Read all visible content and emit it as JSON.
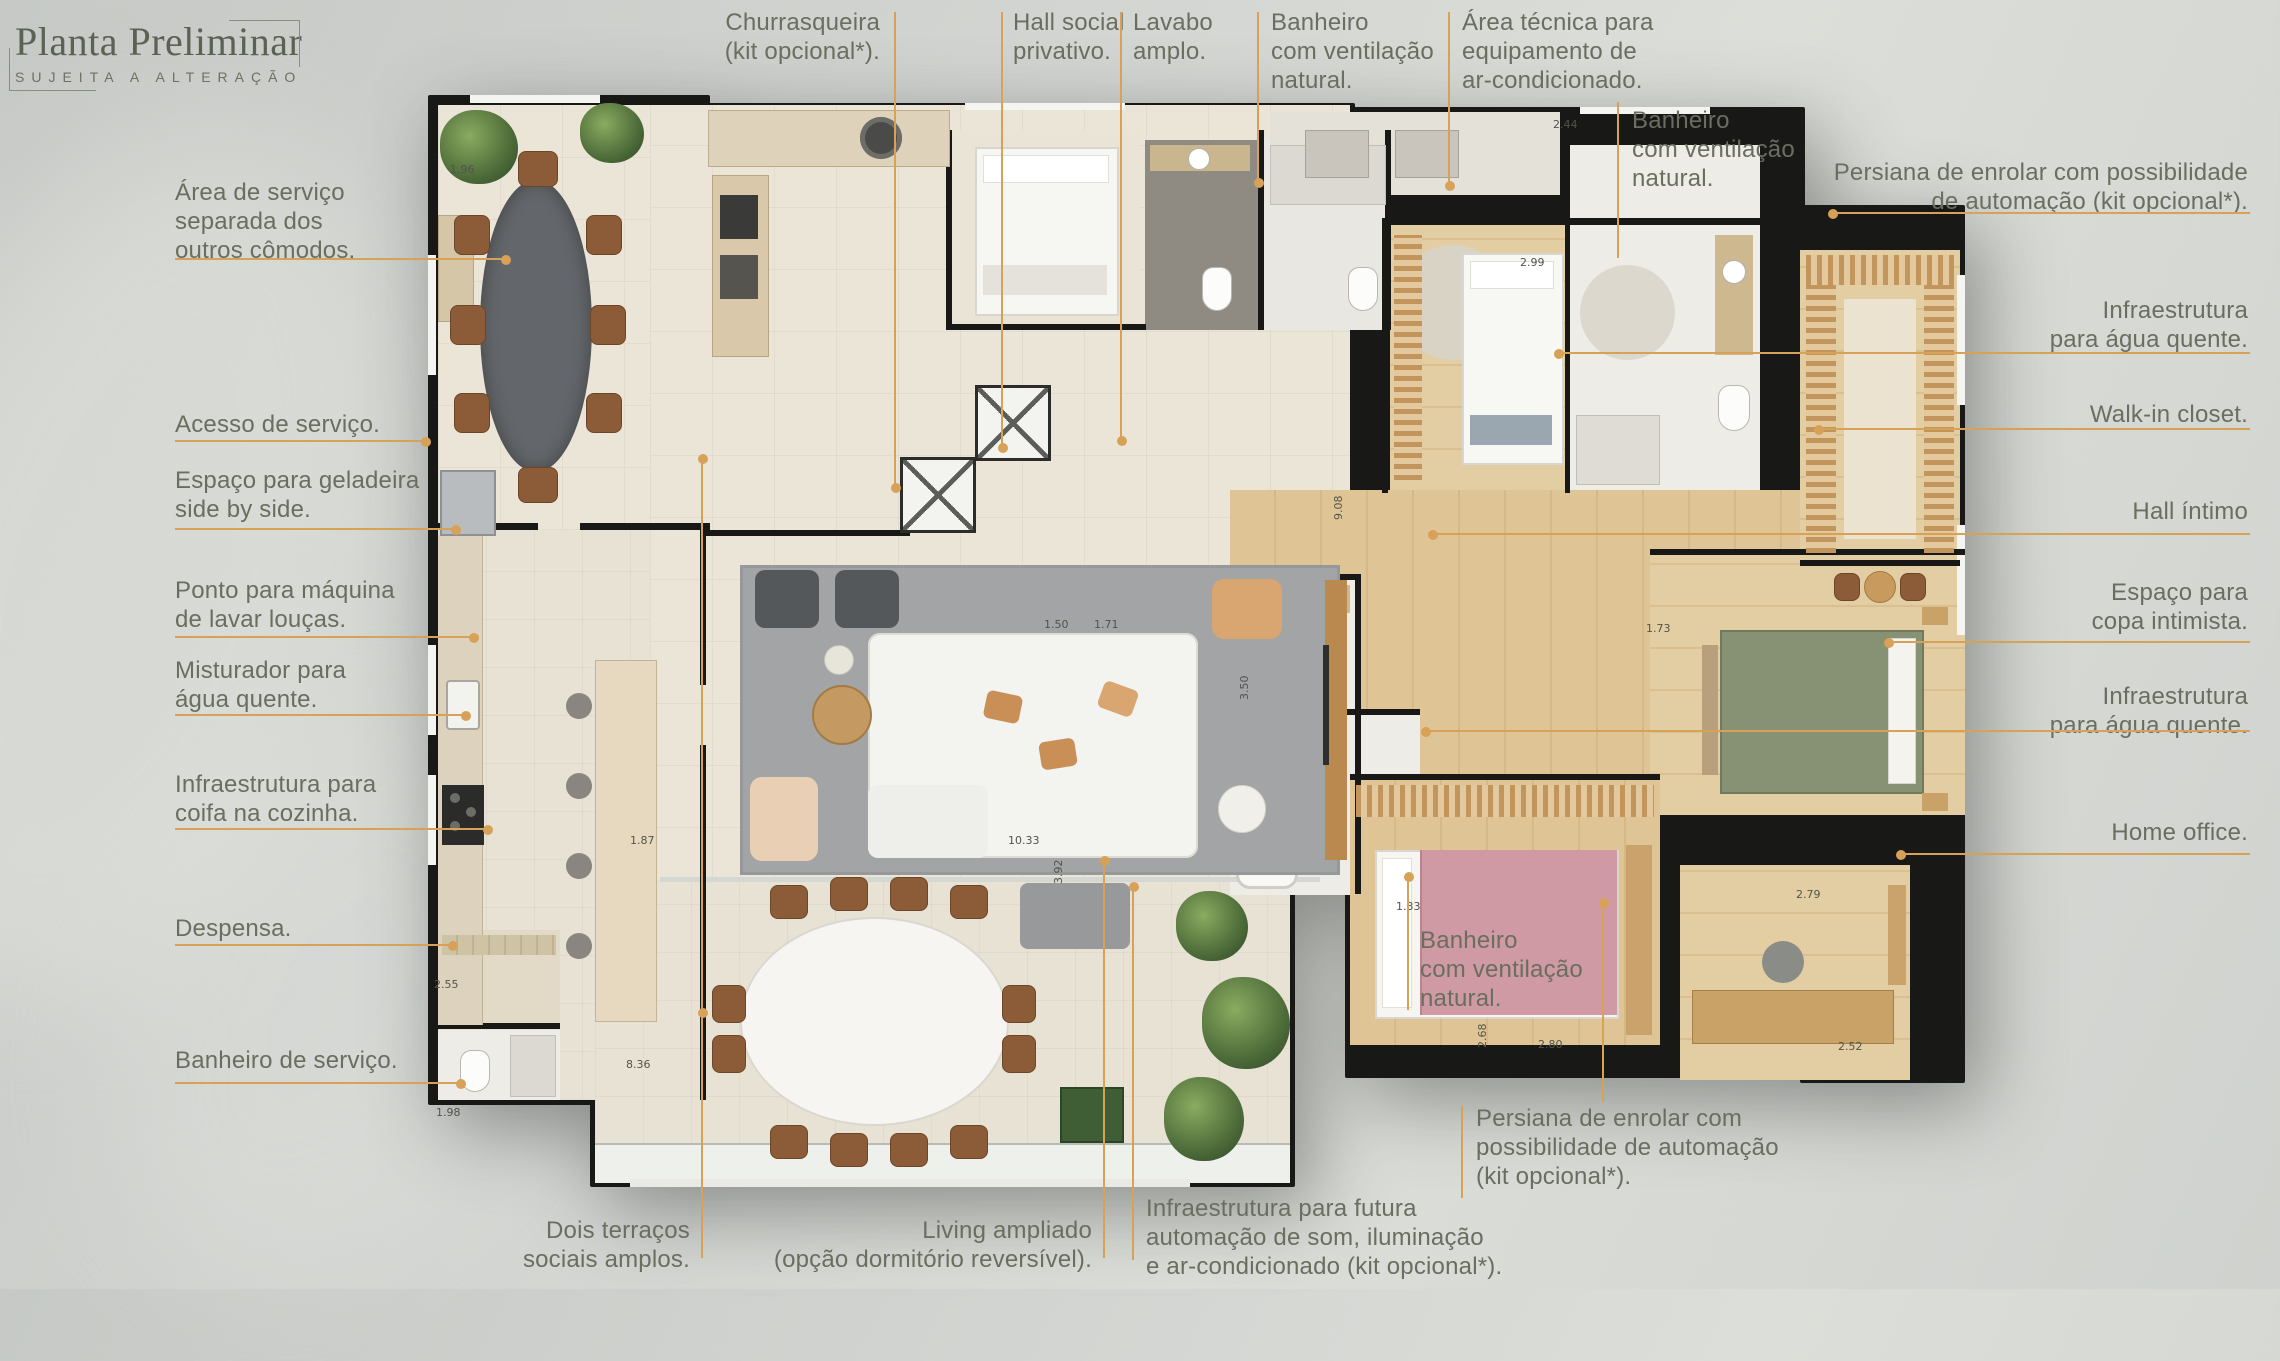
{
  "colors": {
    "accent": "#d7a157",
    "label_text": "#6a6e60",
    "wall": "#181817"
  },
  "logo": {
    "title": "Planta Preliminar",
    "subtitle": "SUJEITA A ALTERAÇÃO"
  },
  "labels": {
    "churrasqueira": "Churrasqueira\n(kit opcional*).",
    "hall_social": "Hall social\nprivativo.",
    "lavabo": "Lavabo\namplo.",
    "banheiro_top": "Banheiro\ncom ventilação\nnatural.",
    "area_tecnica": "Área técnica para\nequipamento de\nar-condicionado.",
    "banheiro_right": "Banheiro\ncom ventilação\nnatural.",
    "persiana_right": "Persiana de enrolar com possibilidade\nde automação (kit opcional*).",
    "infra_agua_1": "Infraestrutura\npara água quente.",
    "walk_in": "Walk-in closet.",
    "hall_intimo": "Hall íntimo",
    "copa": "Espaço para\ncopa intimista.",
    "infra_agua_2": "Infraestrutura\npara água quente.",
    "home_office": "Home office.",
    "area_servico": "Área de serviço\nseparada dos\noutros cômodos.",
    "acesso_servico": "Acesso de serviço.",
    "geladeira": "Espaço para geladeira\nside by side.",
    "maquina_loucas": "Ponto para máquina\nde lavar louças.",
    "misturador": "Misturador para\nágua quente.",
    "coifa": "Infraestrutura para\ncoifa na cozinha.",
    "despensa": "Despensa.",
    "banheiro_servico": "Banheiro de serviço.",
    "dois_terracos": "Dois terraços\nsociais amplos.",
    "living_ampliado": "Living ampliado\n(opção dormitório reversível).",
    "infra_automacao": "Infraestrutura para futura\nautomação de som, iluminação\ne ar-condicionado (kit opcional*).",
    "banheiro_bottom": "Banheiro\ncom ventilação\nnatural.",
    "persiana_bottom": "Persiana de enrolar com\npossibilidade de automação\n(kit opcional*)."
  },
  "dims": [
    {
      "t": "1.96",
      "x": 450,
      "y": 163
    },
    {
      "t": "2.99",
      "x": 1520,
      "y": 256
    },
    {
      "t": "2.44",
      "x": 1553,
      "y": 118
    },
    {
      "t": "1.50",
      "x": 1044,
      "y": 618
    },
    {
      "t": "1.71",
      "x": 1094,
      "y": 618
    },
    {
      "t": "1.73",
      "x": 1646,
      "y": 622
    },
    {
      "t": "9.08",
      "x": 1332,
      "y": 520,
      "v": true
    },
    {
      "t": "3.50",
      "x": 1238,
      "y": 700,
      "v": true
    },
    {
      "t": "1.33",
      "x": 1396,
      "y": 900
    },
    {
      "t": "2.80",
      "x": 1538,
      "y": 1038
    },
    {
      "t": "2.79",
      "x": 1796,
      "y": 888
    },
    {
      "t": "2.52",
      "x": 1838,
      "y": 1040
    },
    {
      "t": "2.68",
      "x": 1476,
      "y": 1048,
      "v": true
    },
    {
      "t": "1.87",
      "x": 630,
      "y": 834
    },
    {
      "t": "10.33",
      "x": 1008,
      "y": 834
    },
    {
      "t": "3.92",
      "x": 1052,
      "y": 884,
      "v": true
    },
    {
      "t": "8.36",
      "x": 626,
      "y": 1058
    },
    {
      "t": "2.55",
      "x": 434,
      "y": 978
    },
    {
      "t": "1.98",
      "x": 436,
      "y": 1106
    }
  ]
}
